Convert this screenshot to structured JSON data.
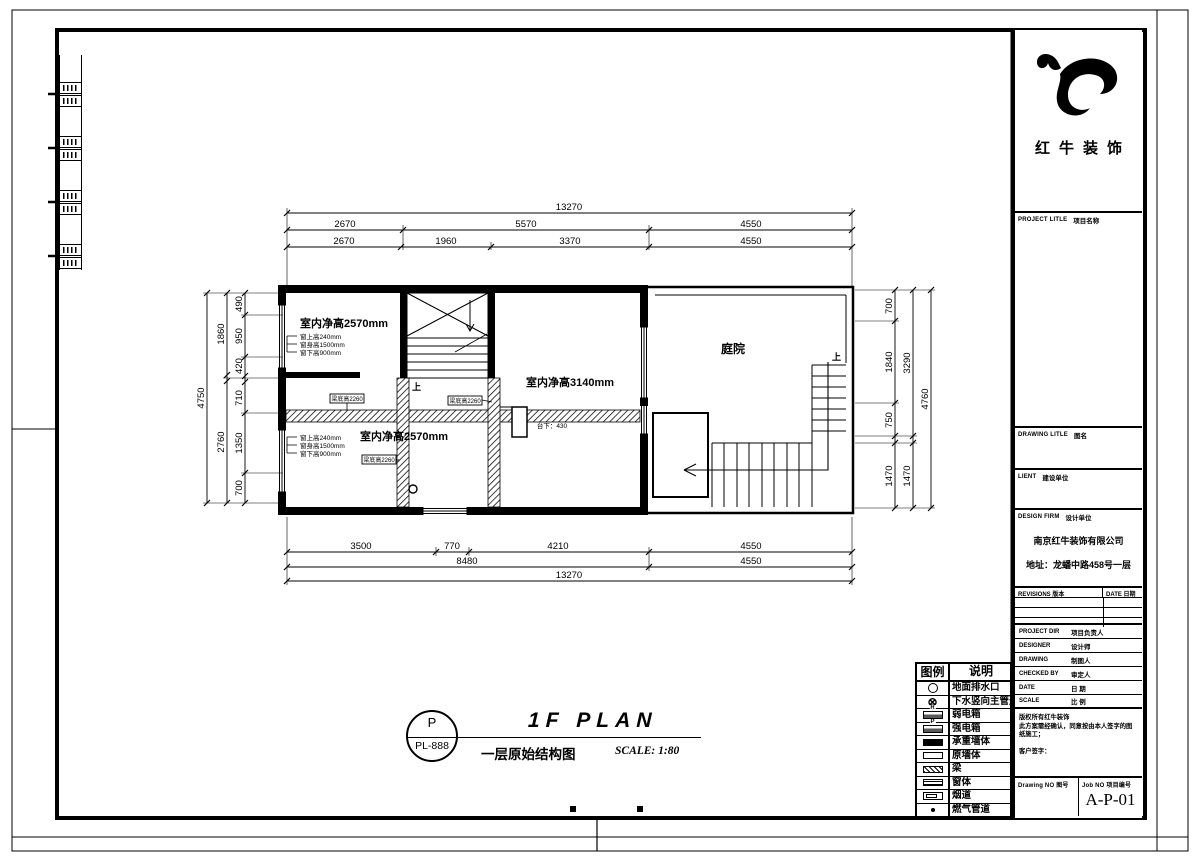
{
  "brand": {
    "name": "红牛装饰"
  },
  "title_block": {
    "project": {
      "en": "PROJECT LITLE",
      "zh": "项目名称"
    },
    "drawing_title": {
      "en": "DRAWING LITLE",
      "zh": "图名"
    },
    "client": {
      "en": "LIENT",
      "zh": "建设单位"
    },
    "design_firm": {
      "en": "DESIGN FIRM",
      "zh": "设计单位"
    },
    "firm_name": "南京红牛装饰有限公司",
    "firm_address": "地址：龙蟠中路458号一层",
    "revisions_label": "REVISIONS 版本",
    "date_col_label": "DATE 日期",
    "people": [
      {
        "en": "PROJECT DIR",
        "zh": "项目负责人"
      },
      {
        "en": "DESIGNER",
        "zh": "设计师"
      },
      {
        "en": "DRAWING",
        "zh": "制图人"
      },
      {
        "en": "CHECKED BY",
        "zh": "审定人"
      },
      {
        "en": "DATE",
        "zh": "日 期"
      },
      {
        "en": "SCALE",
        "zh": "比 例"
      }
    ],
    "notes": [
      "版权所有红牛装饰",
      "此方案需经确认，同意按由本人签字的图纸施工；",
      "客户签字："
    ],
    "drawing_no_label": "Drawing NO 图号",
    "job_no_label": "Job NO 项目编号",
    "job_no": "A-P-01"
  },
  "legend": {
    "header": {
      "symbol": "图例",
      "desc": "说明"
    },
    "items": [
      {
        "icon": "floor-drain-icon",
        "label": "地面排水口"
      },
      {
        "icon": "sewer-main-icon",
        "label": "下水竖向主管道",
        "glyph": "⊗"
      },
      {
        "icon": "weak-current-box-icon",
        "label": "弱电箱",
        "mark": "R"
      },
      {
        "icon": "strong-current-box-icon",
        "label": "强电箱",
        "mark": "P"
      },
      {
        "icon": "load-bearing-wall-icon",
        "label": "承重墙体"
      },
      {
        "icon": "original-wall-icon",
        "label": "原墙体"
      },
      {
        "icon": "beam-icon",
        "label": "梁"
      },
      {
        "icon": "window-icon",
        "label": "窗体"
      },
      {
        "icon": "flue-icon",
        "label": "烟道"
      },
      {
        "icon": "gas-pipe-icon",
        "label": "燃气管道"
      }
    ]
  },
  "plan": {
    "dims_top": {
      "row1": [
        "13270"
      ],
      "row2": [
        "2670",
        "5570",
        "4550"
      ],
      "row3": [
        "2670",
        "1960",
        "3370",
        "4550"
      ]
    },
    "dims_bottom": {
      "row1": [
        "3500",
        "770",
        "4210",
        "4550"
      ],
      "row2": [
        "8480",
        "4550"
      ],
      "row3": [
        "13270"
      ]
    },
    "dims_left": {
      "inner": [
        "490",
        "950",
        "420",
        "710",
        "1350",
        "700"
      ],
      "mid": [
        "1860",
        "2760"
      ],
      "outer": [
        "4750"
      ]
    },
    "dims_right": {
      "inner": [
        "700",
        "1840",
        "750",
        "1470"
      ],
      "mid": [
        "3290",
        "1470"
      ],
      "outer": [
        "4760"
      ]
    },
    "rooms": {
      "upper_left": "室内净高2570mm",
      "middle": "室内净高3140mm",
      "lower_left": "室内净高2570mm",
      "courtyard": "庭院",
      "platform": "台下：430"
    },
    "window_notes": [
      "窗上高240mm",
      "窗身高1500mm",
      "窗下高900mm"
    ],
    "beam_tag": "梁底高2260",
    "stair_up": "上"
  },
  "footer": {
    "bubble_letter": "P",
    "bubble_code": "PL-888",
    "title": "1F PLAN",
    "subtitle": "一层原始结构图",
    "scale": "SCALE: 1:80"
  }
}
